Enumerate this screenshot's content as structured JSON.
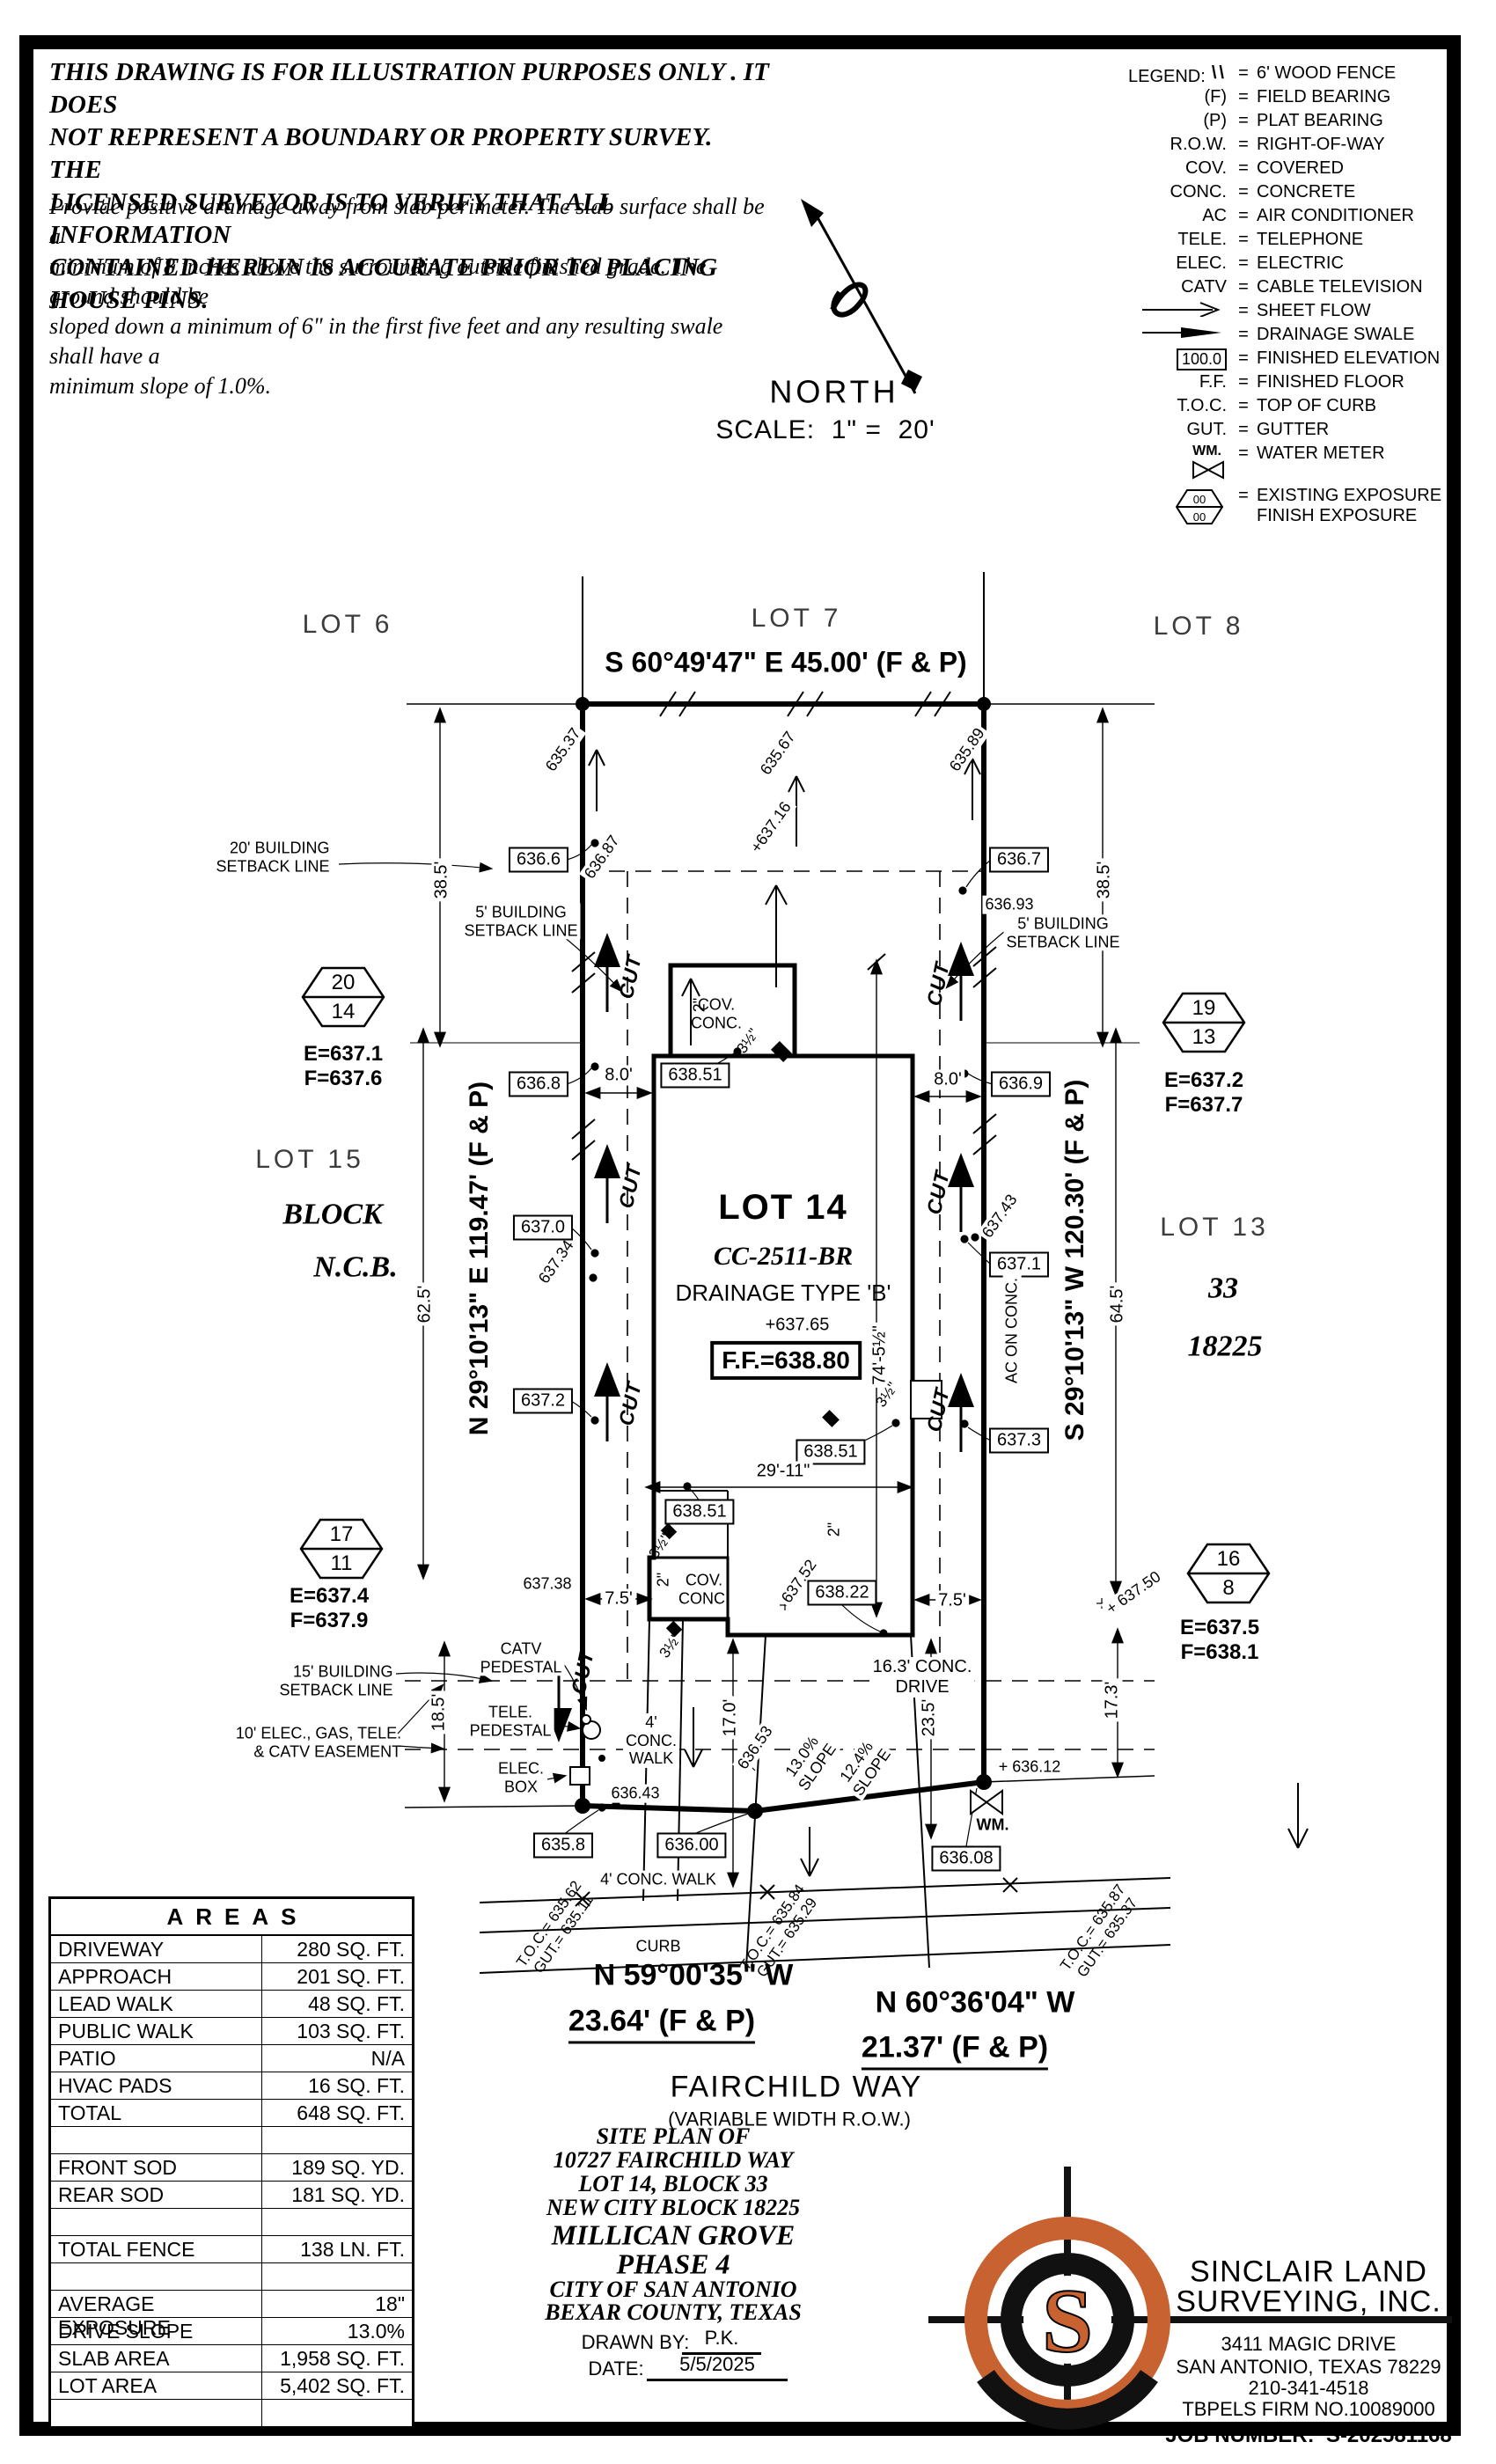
{
  "disclaimer": {
    "para1": "THIS DRAWING IS FOR ILLUSTRATION PURPOSES ONLY . IT DOES\nNOT REPRESENT A BOUNDARY OR PROPERTY SURVEY. THE\nLICENSED SURVEYOR IS TO VERIFY THAT ALL INFORMATION\nCONTAINED HEREIN IS ACCURATE PRIOR TO PLACING HOUSE PINS.",
    "para2": "Provide positive drainage away from slab perimeter. The slab surface shall be a\nminimum of 8 inches above the surrounding outside finished grade. The ground should be\nsloped down a minimum of 6\" in the first five feet and any resulting swale shall have a\nminimum slope of 1.0%."
  },
  "north": {
    "label": "NORTH",
    "scale": "SCALE:  1\" =  20'"
  },
  "legend": {
    "title": "LEGEND:",
    "eq": "=",
    "items": [
      {
        "kind": "fence",
        "sym": "\\\\",
        "text": "6' WOOD FENCE"
      },
      {
        "kind": "txt",
        "sym": "(F)",
        "text": "FIELD BEARING"
      },
      {
        "kind": "txt",
        "sym": "(P)",
        "text": "PLAT BEARING"
      },
      {
        "kind": "txt",
        "sym": "R.O.W.",
        "text": "RIGHT-OF-WAY"
      },
      {
        "kind": "txt",
        "sym": "COV.",
        "text": "COVERED"
      },
      {
        "kind": "txt",
        "sym": "CONC.",
        "text": "CONCRETE"
      },
      {
        "kind": "txt",
        "sym": "AC",
        "text": "AIR CONDITIONER"
      },
      {
        "kind": "txt",
        "sym": "TELE.",
        "text": "TELEPHONE"
      },
      {
        "kind": "txt",
        "sym": "ELEC.",
        "text": "ELECTRIC"
      },
      {
        "kind": "txt",
        "sym": "CATV",
        "text": "CABLE TELEVISION"
      },
      {
        "kind": "sheetflow",
        "sym": "",
        "text": "SHEET FLOW"
      },
      {
        "kind": "swale",
        "sym": "",
        "text": "DRAINAGE SWALE"
      },
      {
        "kind": "boxed",
        "sym": "100.0",
        "text": "FINISHED ELEVATION"
      },
      {
        "kind": "txt",
        "sym": "F.F.",
        "text": "FINISHED FLOOR"
      },
      {
        "kind": "txt",
        "sym": "T.O.C.",
        "text": "TOP OF CURB"
      },
      {
        "kind": "txt",
        "sym": "GUT.",
        "text": "GUTTER"
      },
      {
        "kind": "wm",
        "sym": "WM.",
        "text": "WATER METER"
      },
      {
        "kind": "hex",
        "sym": "00",
        "sym2": "00",
        "text": "EXISTING EXPOSURE\nFINISH EXPOSURE"
      }
    ]
  },
  "labels": {
    "lot6": "LOT 6",
    "lot7": "LOT 7",
    "lot8": "LOT 8",
    "lot15": "LOT 15",
    "lot13": "LOT 13",
    "blk": "BLOCK",
    "ncb": "N.C.B.",
    "n33": "33",
    "n18225": "18225",
    "brgTop": "S 60°49'47\" E 45.00' (F & P)",
    "brgL": "N 29°10'13\" E 119.47' (F & P)",
    "brgR": "S 29°10'13\" W 120.30' (F & P)",
    "brgB1a": "N 59°00'35\" W",
    "brgB1b": "23.64' (F & P)",
    "brgB2a": "N 60°36'04\" W",
    "brgB2b": "21.37' (F & P)",
    "street": "FAIRCHILD WAY",
    "row": "(VARIABLE WIDTH R.O.W.)",
    "e1": "635.37",
    "e2": "635.67",
    "e3": "635.89",
    "e4": "636.87",
    "e5": "+637.16",
    "e6": "636.93",
    "e7": "637.34",
    "e8": "637.43",
    "e9": "637.52",
    "e10": "+637.65",
    "e11": "637.38",
    "e12": "+ 637.50",
    "e13": "636.43",
    "e14": "636.53",
    "e15": "+ 636.12",
    "bx1": "636.6",
    "bx2": "636.7",
    "bx3": "636.8",
    "bx4": "636.9",
    "bx5": "637.0",
    "bx6": "637.1",
    "bx7": "637.2",
    "bx8": "637.3",
    "bx9": "638.51",
    "bx10": "638.51",
    "bx11": "638.51",
    "bx12": "638.22",
    "bx13": "635.8",
    "bx14": "636.00",
    "bx15": "636.08",
    "ff": "F.F.=638.80",
    "d1": "38.5'",
    "d2": "38.5'",
    "d3": "62.5'",
    "d4": "64.5'",
    "d5": "8.0'",
    "d6": "8.0'",
    "d7": "29'-11\"",
    "d8": "74'-5½\"",
    "d9": "7.5'",
    "d10": "7.5'",
    "d11": "17.0'",
    "d12": "23.5'",
    "d13": "17.3'",
    "d14": "18.5'",
    "sb20": "20' BUILDING\nSETBACK LINE",
    "sb5": "5' BUILDING\nSETBACK LINE",
    "sb15": "15' BUILDING\nSETBACK LINE",
    "ease": "10' ELEC., GAS, TELE.\n& CATV EASEMENT",
    "catv": "CATV\nPEDESTAL",
    "tele": "TELE.\nPEDESTAL",
    "ebox": "ELEC.\nBOX",
    "cov": "COV.\nCONC.",
    "ac": "AC ON CONC.",
    "lot14": "LOT 14",
    "cc": "CC-2511-BR",
    "drn": "DRAINAGE TYPE 'B'",
    "drv": "16.3' CONC.\nDRIVE",
    "wlk1": "4'\nCONC.\nWALK",
    "wlk2": "4' CONC. WALK",
    "curb": "CURB",
    "slp1": "13.0%\nSLOPE",
    "slp2": "12.4%\nSLOPE",
    "toc1": "T.O.C.= 635.62\nGUT.= 635.11",
    "toc2": "T.O.C.= 635.84\nGUT.= 635.29",
    "toc3": "T.O.C.= 635.87\nGUT.= 635.37",
    "wm": "WM.",
    "cut": "CUT",
    "in2": "2\"",
    "f35": "3½\"",
    "h1t": "20",
    "h1b": "14",
    "h1e": "E=637.1",
    "h1f": "F=637.6",
    "h2t": "19",
    "h2b": "13",
    "h2e": "E=637.2",
    "h2f": "F=637.7",
    "h3t": "17",
    "h3b": "11",
    "h3e": "E=637.4",
    "h3f": "F=637.9",
    "h4t": "16",
    "h4b": "8",
    "h4e": "E=637.5",
    "h4f": "F=638.1"
  },
  "areas": {
    "title": "AREAS",
    "rows": [
      {
        "l": "DRIVEWAY",
        "v": "280 SQ. FT."
      },
      {
        "l": "APPROACH",
        "v": "201 SQ. FT."
      },
      {
        "l": "LEAD WALK",
        "v": "48 SQ. FT."
      },
      {
        "l": "PUBLIC WALK",
        "v": "103 SQ. FT."
      },
      {
        "l": "PATIO",
        "v": "N/A"
      },
      {
        "l": "HVAC PADS",
        "v": "16 SQ. FT."
      },
      {
        "l": "TOTAL",
        "v": "648 SQ. FT."
      },
      {
        "l": "",
        "v": ""
      },
      {
        "l": "FRONT SOD",
        "v": "189 SQ. YD."
      },
      {
        "l": "REAR SOD",
        "v": "181 SQ. YD."
      },
      {
        "l": "",
        "v": ""
      },
      {
        "l": "TOTAL FENCE",
        "v": "138 LN. FT."
      },
      {
        "l": "",
        "v": ""
      },
      {
        "l": "AVERAGE EXPOSURE",
        "v": "18\""
      },
      {
        "l": "DRIVE SLOPE",
        "v": "13.0%"
      },
      {
        "l": "SLAB AREA",
        "v": "1,958 SQ. FT."
      },
      {
        "l": "LOT AREA",
        "v": "5,402 SQ. FT."
      },
      {
        "l": "",
        "v": ""
      }
    ]
  },
  "title_block": {
    "l1": "SITE PLAN OF",
    "l2": "10727 FAIRCHILD WAY",
    "l3": "LOT 14, BLOCK 33",
    "l4": "NEW CITY BLOCK 18225",
    "l5": "MILLICAN GROVE",
    "l6": "PHASE 4",
    "l7": "CITY OF SAN ANTONIO",
    "l8": "BEXAR COUNTY, TEXAS",
    "drawn_label": "DRAWN BY:",
    "drawn_val": "P.K.",
    "date_label": "DATE:",
    "date_val": "5/5/2025"
  },
  "surveyor": {
    "name1": "SINCLAIR LAND",
    "name2": "SURVEYING, INC.",
    "addr1": "3411 MAGIC DRIVE",
    "addr2": "SAN ANTONIO, TEXAS 78229",
    "phone": "210-341-4518",
    "firm": "TBPELS FIRM NO.10089000",
    "job": "JOB NUMBER:  S-202581168",
    "logo_letter": "S",
    "brand_orange": "#C96231",
    "ink": "#000000"
  }
}
